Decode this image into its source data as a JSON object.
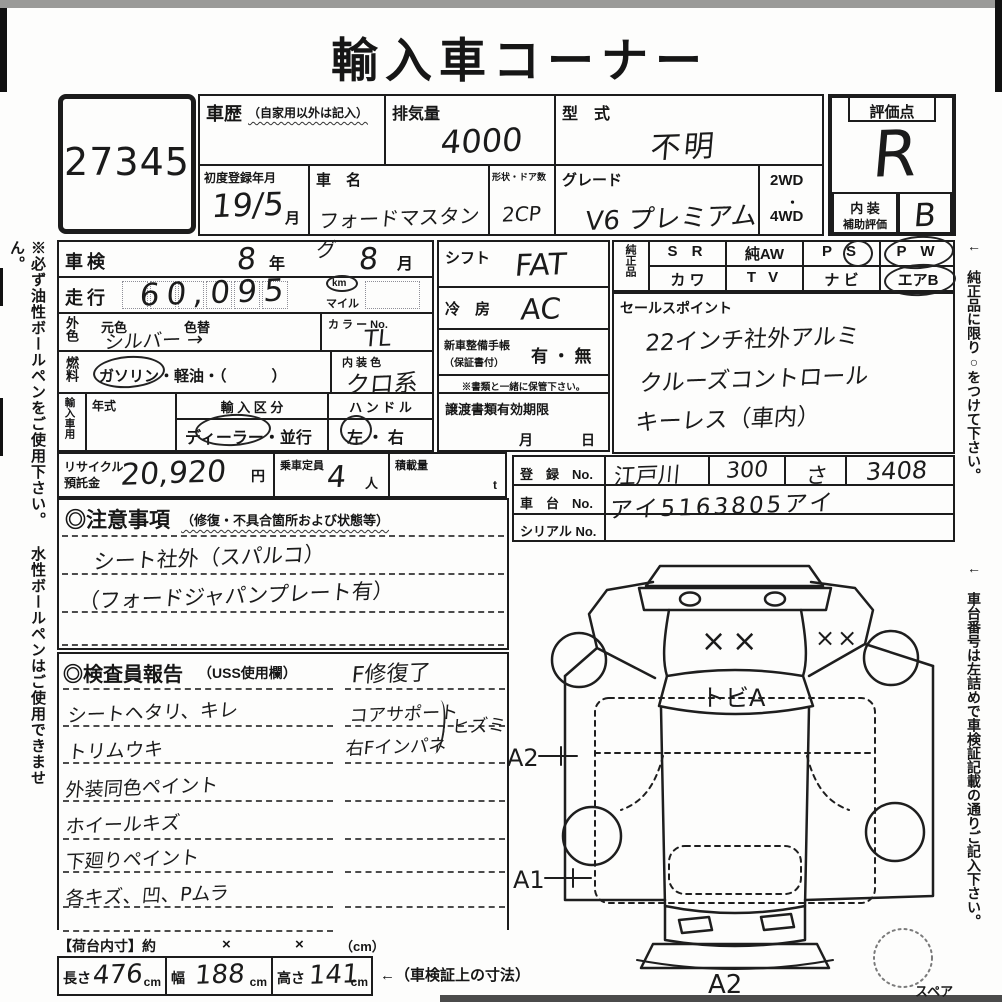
{
  "page": {
    "title": "輸入車コーナー",
    "auction_no": "27345",
    "left_note": "※必ず油性ボールペンをご使用下さい。 水性ボールペンはご使用できません。",
    "right_note_top": "← 純正品に限り○をつけて下さい。",
    "right_note_bottom": "← 車台番号は左詰めで車検証記載の通りご記入下さい。"
  },
  "header": {
    "history_label": "車歴",
    "history_note": "（自家用以外は記入）",
    "displacement_label": "排気量",
    "displacement_value": "4000",
    "model_code_label": "型　式",
    "model_code_value": "不明",
    "first_reg_label": "初度登録年月",
    "first_reg_value": "19/5",
    "first_reg_unit": "月",
    "car_name_label": "車　名",
    "car_name_value": "フォードマスタング",
    "body_doors_label": "形状・ドア数",
    "body_doors_value": "2CP",
    "grade_label": "グレード",
    "grade_value": "V6 プレミアム",
    "drive_2wd": "2WD",
    "drive_dot": "・",
    "drive_4wd": "4WD",
    "score_label": "評価点",
    "score_value": "R",
    "interior_label": "内 装",
    "interior_sub": "補助評価",
    "interior_value": "B"
  },
  "left": {
    "shaken_label": "車検",
    "shaken_year": "8",
    "year_unit": "年",
    "shaken_month": "8",
    "month_unit": "月",
    "mileage_label": "走行",
    "mileage_value": "60,095",
    "unit_km": "km",
    "unit_mile": "マイル",
    "color_label": "外色",
    "base_color_label": "元色",
    "color_change_label": "色替",
    "color_value": "シルバー →",
    "color_no_label": "カ ラ ー No.",
    "color_no_value": "TL",
    "fuel_label": "燃料",
    "fuel_options": "ガソリン・軽油・（　　　）",
    "interior_color_label": "内 装 色",
    "interior_color_value": "クロ系",
    "import_label": "輸入車用",
    "year_label": "年式",
    "import_class_label": "輸 入 区 分",
    "import_class_value": "ディーラー・並行",
    "handle_label": "ハ ン ド ル",
    "handle_value": "左 ・ 右",
    "recycle_label1": "リサイクル",
    "recycle_label2": "預託金",
    "recycle_value": "20,920",
    "recycle_unit": "円",
    "capacity_label": "乗車定員",
    "capacity_value": "4",
    "capacity_unit": "人",
    "load_label": "積載量",
    "load_unit": "t"
  },
  "middle": {
    "shift_label": "シフト",
    "shift_value": "FAT",
    "ac_label": "冷　房",
    "ac_value": "AC",
    "booklet_label": "新車整備手帳",
    "booklet_sub": "（保証書付）",
    "booklet_value": "有 ・ 無",
    "booklet_note": "※書類と一緒に保管下さい。",
    "transfer_label": "譲渡書類有効期限",
    "transfer_month": "月",
    "transfer_day": "日"
  },
  "genuine": {
    "label": "純正品",
    "cells": {
      "r1c1": "S R",
      "r1c2": "純AW",
      "r1c3": "P S",
      "r1c4": "P W",
      "r2c1": "カ ワ",
      "r2c2": "T V",
      "r2c3": "ナ ビ",
      "r2c4": "エアB"
    }
  },
  "sales": {
    "label": "セールスポイント",
    "lines": [
      "22インチ社外アルミ",
      "クルーズコントロール",
      "キーレス（車内）"
    ]
  },
  "registration": {
    "reg_label": "登　録　No.",
    "area": "江戸川",
    "class_no": "300",
    "kana": "さ",
    "number": "3408",
    "chassis_label": "車　台　No.",
    "chassis_value": "アイ5163805アイ",
    "serial_label": "シリアル No."
  },
  "notes": {
    "header": "◎注意事項",
    "header_sub": "（修復・不具合箇所および状態等）",
    "lines": [
      "シート社外（スパルコ）",
      "（フォードジャパンプレート有）"
    ]
  },
  "inspector": {
    "header": "◎検査員報告",
    "header_sub": "（USS使用欄）",
    "top_note": "F修復了",
    "items_left": [
      "シートヘタリ、キレ",
      "トリムウキ",
      "外装同色ペイント",
      "ホイールキズ",
      "下廻りペイント",
      "各キズ、凹、Pムラ"
    ],
    "items_right": [
      "コアサポート",
      "右Fインパネ"
    ],
    "brace_note": "ヒズミ"
  },
  "diagram": {
    "hood_mark": "××",
    "fender_mark": "××",
    "windshield_note": "トビA",
    "a2_left": "A2",
    "a1": "A1",
    "a2_bottom": "A2",
    "spare_label": "スペア"
  },
  "cargo": {
    "label": "【荷台内寸】約",
    "x1": "×",
    "x2": "×",
    "unit": "（cm）",
    "length_label": "長さ",
    "length_value": "476",
    "length_unit": "cm",
    "width_label": "幅",
    "width_value": "188",
    "width_unit": "cm",
    "height_label": "高さ",
    "height_value": "141",
    "height_unit": "cm",
    "dims_note": "←（車検証上の寸法）"
  }
}
